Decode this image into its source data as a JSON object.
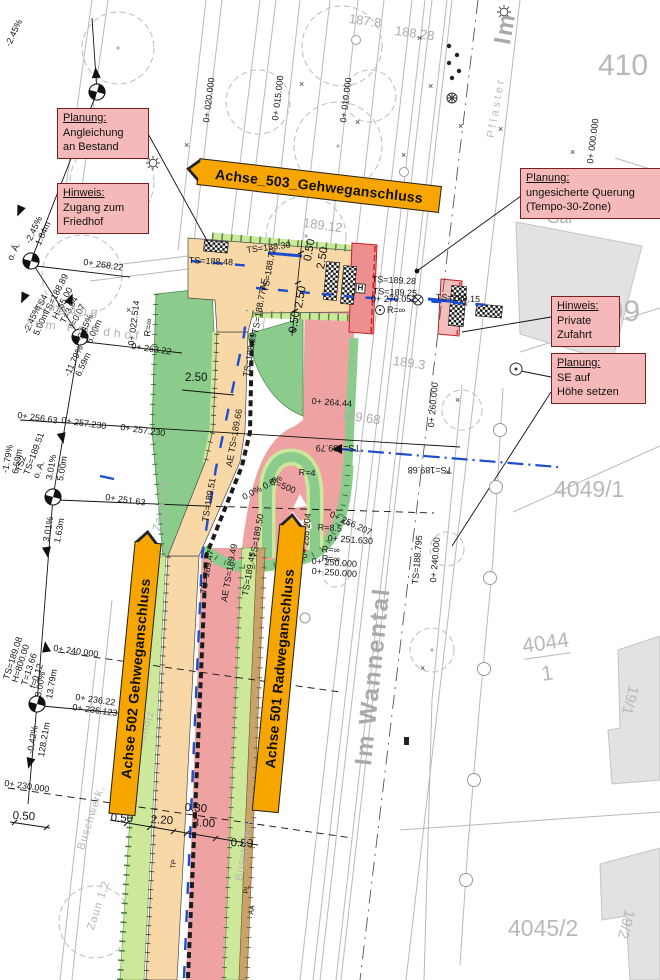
{
  "colors": {
    "banner": "#f7a600",
    "annBg": "#f5b9b9",
    "annBd": "#7a1f1f",
    "red": "#efa2a2",
    "xred": "#ee8f8f",
    "xred2": "#f3bdbd",
    "green": "#8bcb8b",
    "lgreen": "#cde89a",
    "tan": "#f7d8a6",
    "brown": "#c9a36a",
    "blue": "#1d4ed0"
  },
  "annotations": [
    {
      "title": "Planung:",
      "l1": "Angleichung",
      "l2": "an Bestand"
    },
    {
      "title": "Hinweis:",
      "l1": "Zugang zum",
      "l2": "Friedhof"
    },
    {
      "title": "Planung:",
      "l1": "ungesicherte Querung",
      "l2": "(Tempo-30-Zone)"
    },
    {
      "title": "Hinweis:",
      "l1": "Private",
      "l2": "Zufahrt"
    },
    {
      "title": "Planung:",
      "l1": "SE auf",
      "l2": "Höhe setzen"
    }
  ],
  "banners": [
    {
      "label": "Achse_503_Gehweganschluss"
    },
    {
      "label": "Achse 502 Gehweganschluss"
    },
    {
      "label": "Achse 501 Radweganschluss"
    }
  ],
  "map_labels": [
    {
      "t": "0+ 268.22",
      "x": 84,
      "y": 258,
      "r": 8
    },
    {
      "t": "0+ 263.22",
      "x": 132,
      "y": 342,
      "r": 8
    },
    {
      "t": "0+ 022.514",
      "x": 127,
      "y": 345,
      "r": -83
    },
    {
      "t": "R=∞",
      "x": 143,
      "y": 336,
      "r": -83
    },
    {
      "t": "0+ 256.63",
      "x": 18,
      "y": 411,
      "r": 8
    },
    {
      "t": "0+ 257.230",
      "x": 62,
      "y": 416,
      "r": 8
    },
    {
      "t": "0+ 257.230",
      "x": 121,
      "y": 423,
      "r": 8
    },
    {
      "t": "0+ 251.63",
      "x": 106,
      "y": 493,
      "r": 8
    },
    {
      "t": "0+ 240.000",
      "x": 54,
      "y": 644,
      "r": 8
    },
    {
      "t": "0+ 236.22",
      "x": 76,
      "y": 693,
      "r": 8
    },
    {
      "t": "0+ 236.123",
      "x": 73,
      "y": 703,
      "r": 8
    },
    {
      "t": "0+ 230.000",
      "x": 5,
      "y": 779,
      "r": 8
    },
    {
      "t": "0+ 270.052",
      "x": 371,
      "y": 295
    },
    {
      "t": "R=∞",
      "x": 387,
      "y": 306
    },
    {
      "t": "0+ 264.44",
      "x": 312,
      "y": 397,
      "r": 4
    },
    {
      "t": "0+ 256.207",
      "x": 332,
      "y": 510,
      "r": 25
    },
    {
      "t": "R=8.5",
      "x": 318,
      "y": 523,
      "r": 4
    },
    {
      "t": "0+ 251.630",
      "x": 328,
      "y": 534,
      "r": 4
    },
    {
      "t": "R=∞",
      "x": 322,
      "y": 545,
      "r": 4
    },
    {
      "t": "R=∞",
      "x": 322,
      "y": 554,
      "r": 4
    },
    {
      "t": "0+ 250.000",
      "x": 312,
      "y": 557,
      "r": 4
    },
    {
      "t": "0+ 250.000",
      "x": 312,
      "y": 567,
      "r": 4
    },
    {
      "t": "0+ 255.204",
      "x": 300,
      "y": 558,
      "r": -85
    },
    {
      "t": "0+ 260.000",
      "x": 427,
      "y": 427,
      "r": -85
    },
    {
      "t": "0+ 240.000",
      "x": 429,
      "y": 582,
      "r": -85
    },
    {
      "t": "0+ 020.000",
      "x": 202,
      "y": 122,
      "r": -83
    },
    {
      "t": "0+ 015.000",
      "x": 271,
      "y": 120,
      "r": -83
    },
    {
      "t": "0+ 010.000",
      "x": 339,
      "y": 122,
      "r": -83
    },
    {
      "t": "0+ 000.000",
      "x": 586,
      "y": 163,
      "r": -83
    },
    {
      "t": "TS=188.795",
      "x": 411,
      "y": 584,
      "r": -85
    },
    {
      "t": "TS=188.30",
      "x": 246,
      "y": 246,
      "r": -7
    },
    {
      "t": "TS=188.48",
      "x": 189,
      "y": 256,
      "r": 3
    },
    {
      "t": "TS=188.72",
      "x": 261,
      "y": 291,
      "r": -80
    },
    {
      "t": "TS=188.77AE",
      "x": 251,
      "y": 333,
      "r": -80
    },
    {
      "t": "TS=188.89",
      "x": 242,
      "y": 376,
      "r": -80
    },
    {
      "t": "AE TS=189.66",
      "x": 225,
      "y": 466,
      "r": -80
    },
    {
      "t": "TS=189.51",
      "x": 201,
      "y": 521,
      "r": -80
    },
    {
      "t": "TS=189.47",
      "x": 199,
      "y": 593,
      "r": -80
    },
    {
      "t": "AE TS=189.49",
      "x": 220,
      "y": 601,
      "r": -80
    },
    {
      "t": "TS=189.45",
      "x": 241,
      "y": 595,
      "r": -80
    },
    {
      "t": "TS=189.50",
      "x": 249,
      "y": 557,
      "r": -80
    },
    {
      "t": "TS=189.79",
      "x": 360,
      "y": 452,
      "r": 180
    },
    {
      "t": "TS=189.68",
      "x": 452,
      "y": 474,
      "r": 180
    },
    {
      "t": "TS=189.28",
      "x": 372,
      "y": 275,
      "r": 3,
      "c": "bl"
    },
    {
      "t": "TS=189.25",
      "x": 373,
      "y": 287,
      "r": 3,
      "c": "bl"
    },
    {
      "t": "TS=189.15",
      "x": 436,
      "y": 293,
      "r": 3
    },
    {
      "t": "TS2\nTS=189.51\no. A.",
      "x": 14,
      "y": 470,
      "r": -70
    },
    {
      "t": "TS4\nTS=188.89\nH=65.00\nT=3.04\nf=0.07",
      "x": 34,
      "y": 308,
      "r": -63
    },
    {
      "t": "TS=189.08\nH=800.00\nT=13.66\nf=0.12",
      "x": 2,
      "y": 678,
      "r": -72
    },
    {
      "t": "-2.45%",
      "x": 4,
      "y": 44,
      "r": -65
    },
    {
      "t": "o. Ä.",
      "x": 6,
      "y": 258,
      "r": -65
    },
    {
      "t": "-2.45%",
      "x": 24,
      "y": 241,
      "r": -65
    },
    {
      "t": "1.84m",
      "x": 34,
      "y": 243,
      "r": -65
    },
    {
      "t": "-2.45%",
      "x": 22,
      "y": 331,
      "r": -65
    },
    {
      "t": "5.00m",
      "x": 32,
      "y": 333,
      "r": -65
    },
    {
      "t": "-2.45%",
      "x": 75,
      "y": 339,
      "r": -65
    },
    {
      "t": "5.00m",
      "x": 85,
      "y": 341,
      "r": -65
    },
    {
      "t": "-11.79%",
      "x": 63,
      "y": 374,
      "r": -65
    },
    {
      "t": "6.59m",
      "x": 74,
      "y": 374,
      "r": -65
    },
    {
      "t": "-1.79%",
      "x": 1,
      "y": 472,
      "r": -80
    },
    {
      "t": "6.59m",
      "x": 11,
      "y": 473,
      "r": -80
    },
    {
      "t": "3.01%",
      "x": 45,
      "y": 479,
      "r": -80
    },
    {
      "t": "5.00m",
      "x": 56,
      "y": 480,
      "r": -80
    },
    {
      "t": "3.01%",
      "x": 42,
      "y": 541,
      "r": -80
    },
    {
      "t": "1.63m",
      "x": 53,
      "y": 542,
      "r": -80
    },
    {
      "t": "3.00%",
      "x": 34,
      "y": 696,
      "r": -80
    },
    {
      "t": "13.79m",
      "x": 45,
      "y": 698,
      "r": -80
    },
    {
      "t": "-0.42%",
      "x": 26,
      "y": 753,
      "r": -80
    },
    {
      "t": "128.21m",
      "x": 37,
      "y": 756,
      "r": -80
    },
    {
      "t": "2.50",
      "x": 185,
      "y": 372,
      "c": "d"
    },
    {
      "t": "0.50",
      "x": 302,
      "y": 260,
      "r": -80,
      "c": "d"
    },
    {
      "t": "2.50",
      "x": 315,
      "y": 268,
      "r": -80,
      "c": "d"
    },
    {
      "t": "2.50",
      "x": 293,
      "y": 307,
      "r": -80,
      "c": "d"
    },
    {
      "t": "0.50",
      "x": 287,
      "y": 332,
      "r": -80,
      "c": "d"
    },
    {
      "t": "0.50",
      "x": 13,
      "y": 810,
      "r": 3,
      "c": "d"
    },
    {
      "t": "0.50",
      "x": 111,
      "y": 812,
      "r": 3,
      "c": "d"
    },
    {
      "t": "2.20",
      "x": 151,
      "y": 814,
      "r": 3,
      "c": "d"
    },
    {
      "t": "0.30",
      "x": 185,
      "y": 802,
      "r": 3,
      "c": "d"
    },
    {
      "t": "3.00",
      "x": 193,
      "y": 817,
      "r": 3,
      "c": "d"
    },
    {
      "t": "0.50",
      "x": 231,
      "y": 837,
      "r": 3,
      "c": "d"
    },
    {
      "t": "H",
      "x": 356,
      "y": 283,
      "r": 5,
      "c": "hb"
    },
    {
      "t": "0.0% 0.0%",
      "x": 241,
      "y": 494,
      "r": -28
    },
    {
      "t": "R=500",
      "x": 272,
      "y": 477,
      "r": 22
    },
    {
      "t": "R=4",
      "x": 299,
      "y": 468,
      "r": 4
    },
    {
      "t": "TP",
      "x": 170,
      "y": 868,
      "r": -80,
      "c": "sm"
    },
    {
      "t": "PL",
      "x": 243,
      "y": 893,
      "r": -80,
      "c": "sm"
    },
    {
      "t": "AA",
      "x": 248,
      "y": 914,
      "r": -80,
      "c": "sm"
    },
    {
      "t": "AA",
      "x": 342,
      "y": 518,
      "r": 25,
      "c": "sm"
    },
    {
      "t": "Zugang",
      "x": 38,
      "y": 299,
      "r": 7,
      "c": "gsp"
    },
    {
      "t": "zum Friedhof",
      "x": 26,
      "y": 316,
      "r": 7,
      "c": "gsp"
    },
    {
      "t": "Buschwerk,",
      "x": 76,
      "y": 848,
      "r": -72,
      "c": "gm"
    },
    {
      "t": "Gehölz",
      "x": 134,
      "y": 748,
      "r": -72,
      "c": "gm"
    },
    {
      "t": "Zaun 1,2",
      "x": 86,
      "y": 928,
      "r": -72,
      "c": "gm"
    },
    {
      "t": "Buschwerk",
      "x": 234,
      "y": 880,
      "r": -80,
      "c": "gm"
    },
    {
      "t": "Zaun 0,3",
      "x": 152,
      "y": 530,
      "r": -80,
      "c": "gm"
    },
    {
      "t": "Pflaster",
      "x": 486,
      "y": 137,
      "r": -80,
      "c": "gsp2"
    },
    {
      "t": "Im Wannental",
      "x": 351,
      "y": 764,
      "r": -84,
      "c": "gst"
    },
    {
      "t": "Im",
      "x": 490,
      "y": 42,
      "r": -80,
      "c": "gst"
    },
    {
      "t": "Gar",
      "x": 547,
      "y": 211,
      "c": "gb"
    },
    {
      "t": "410",
      "x": 598,
      "y": 50,
      "c": "gp1"
    },
    {
      "t": "409",
      "x": 590,
      "y": 296,
      "c": "gp1"
    },
    {
      "t": "4049/1",
      "x": 554,
      "y": 477,
      "c": "gp2"
    },
    {
      "t": "4045/2",
      "x": 508,
      "y": 916,
      "c": "gp2"
    },
    {
      "t": "4044",
      "x": 521,
      "y": 636,
      "r": -8,
      "c": "gp3 uf"
    },
    {
      "t": "1",
      "x": 540,
      "y": 664,
      "r": -8,
      "c": "gp3"
    },
    {
      "t": "19/1",
      "x": 641,
      "y": 688,
      "r": 105,
      "c": "gp4"
    },
    {
      "t": "19/2",
      "x": 637,
      "y": 912,
      "r": 105,
      "c": "gp4"
    },
    {
      "t": "187.8",
      "x": 350,
      "y": 12,
      "r": 8,
      "c": "ge"
    },
    {
      "t": "188.28",
      "x": 396,
      "y": 24,
      "r": 8,
      "c": "ge"
    },
    {
      "t": "189.12",
      "x": 304,
      "y": 216,
      "r": 8,
      "c": "ge"
    },
    {
      "t": "189.3",
      "x": 394,
      "y": 354,
      "r": 8,
      "c": "ge"
    },
    {
      "t": "189.68",
      "x": 342,
      "y": 408,
      "r": 8,
      "c": "ge"
    },
    {
      "t": "×",
      "x": 184,
      "y": 141,
      "c": "xm"
    },
    {
      "t": "×",
      "x": 417,
      "y": 34,
      "c": "xm"
    },
    {
      "t": "×",
      "x": 458,
      "y": 122,
      "c": "xm"
    },
    {
      "t": "×",
      "x": 498,
      "y": 125,
      "c": "xm"
    },
    {
      "t": "×",
      "x": 401,
      "y": 151,
      "c": "xm"
    },
    {
      "t": "×",
      "x": 299,
      "y": 80,
      "c": "xm"
    },
    {
      "t": "×",
      "x": 126,
      "y": 306,
      "c": "xm"
    },
    {
      "t": "×",
      "x": 428,
      "y": 82,
      "c": "xm"
    },
    {
      "t": "×",
      "x": 570,
      "y": 148,
      "c": "xm"
    },
    {
      "t": "×",
      "x": 455,
      "y": 396,
      "c": "xm"
    },
    {
      "t": "×",
      "x": 445,
      "y": 468,
      "c": "xm"
    },
    {
      "t": "×",
      "x": 420,
      "y": 664,
      "c": "xm"
    },
    {
      "t": "×",
      "x": 355,
      "y": 118,
      "c": "xm"
    },
    {
      "t": "×",
      "x": 463,
      "y": 300,
      "c": "xm"
    }
  ]
}
